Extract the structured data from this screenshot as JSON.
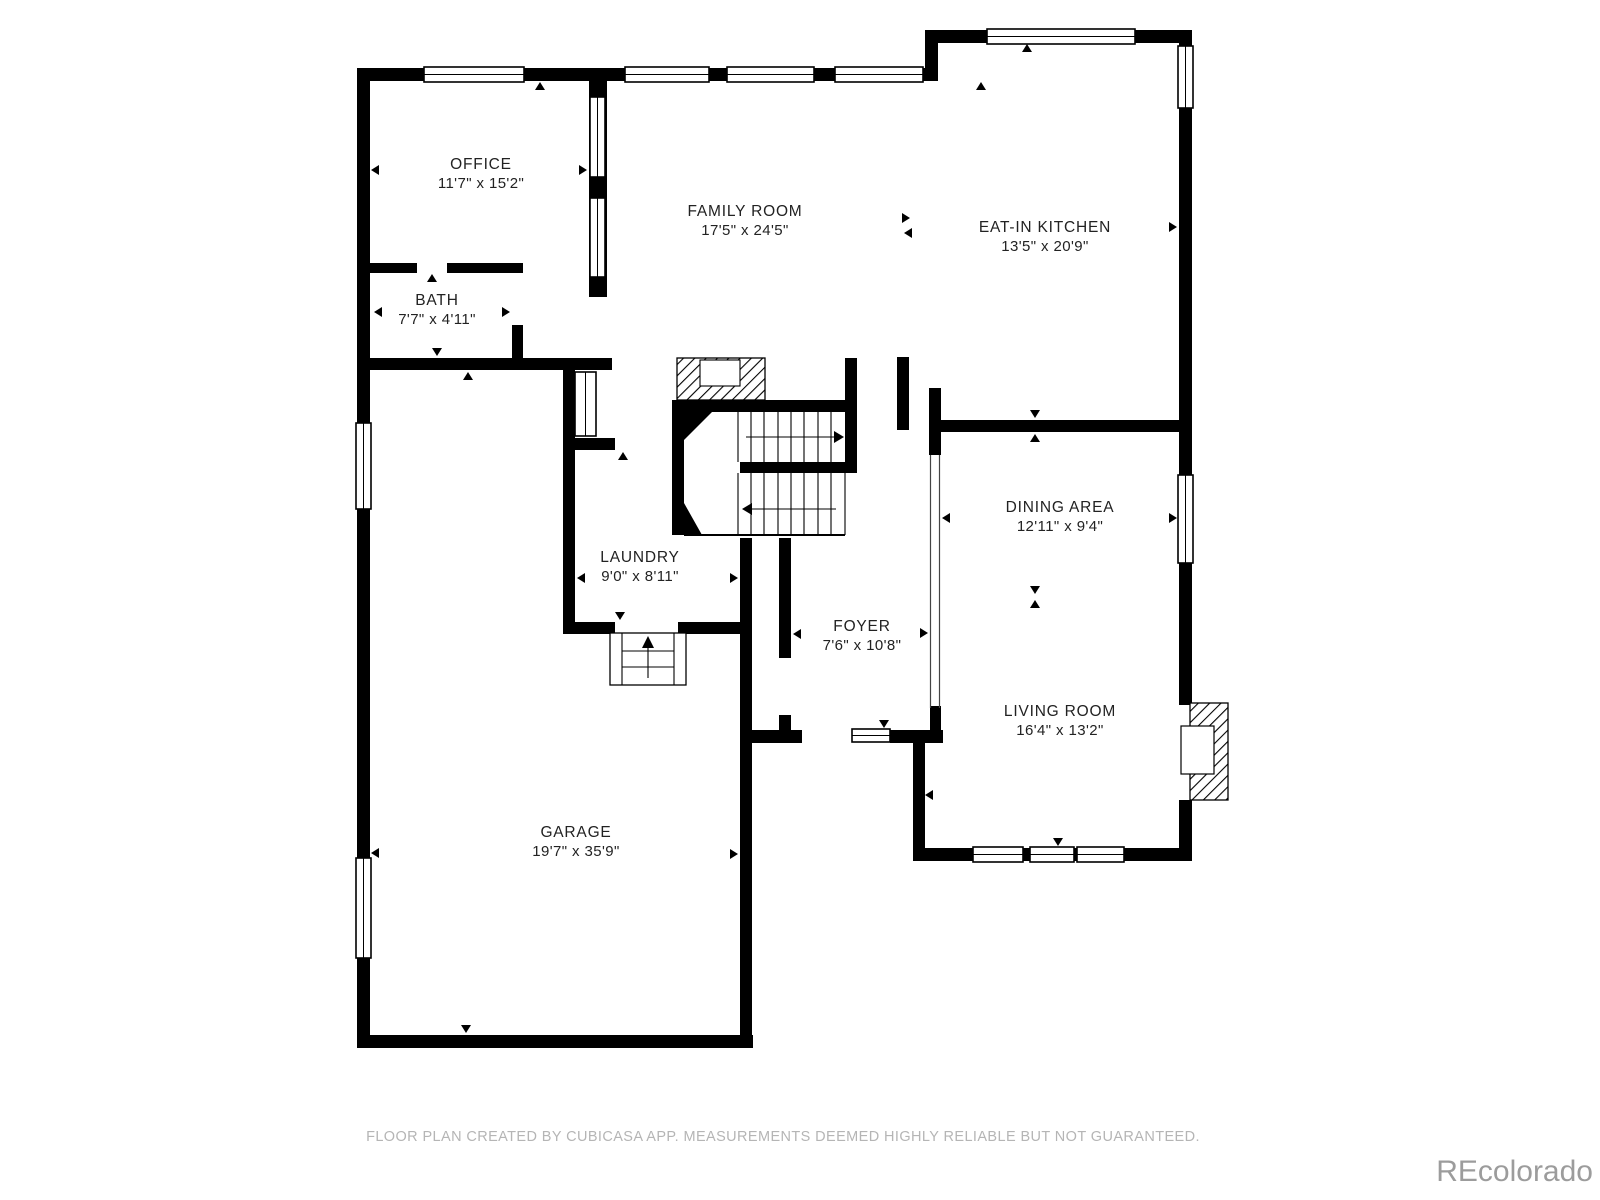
{
  "plan": {
    "creator_line": "FLOOR PLAN CREATED BY CUBICASA APP. MEASUREMENTS DEEMED HIGHLY RELIABLE BUT NOT GUARANTEED.",
    "watermark": "REcolorado"
  },
  "rooms": [
    {
      "id": "office",
      "name": "OFFICE",
      "dims": "11'7\" x 15'2\""
    },
    {
      "id": "family",
      "name": "FAMILY ROOM",
      "dims": "17'5\" x 24'5\""
    },
    {
      "id": "kitchen",
      "name": "EAT-IN KITCHEN",
      "dims": "13'5\" x 20'9\""
    },
    {
      "id": "bath",
      "name": "BATH",
      "dims": "7'7\" x 4'11\""
    },
    {
      "id": "laundry",
      "name": "LAUNDRY",
      "dims": "9'0\" x 8'11\""
    },
    {
      "id": "dining",
      "name": "DINING AREA",
      "dims": "12'11\" x 9'4\""
    },
    {
      "id": "foyer",
      "name": "FOYER",
      "dims": "7'6\" x 10'8\""
    },
    {
      "id": "living",
      "name": "LIVING ROOM",
      "dims": "16'4\" x 13'2\""
    },
    {
      "id": "garage",
      "name": "GARAGE",
      "dims": "19'7\" x 35'9\""
    }
  ],
  "colors": {
    "wall": "#000000",
    "background": "#ffffff",
    "label_text": "#222222",
    "footer_text": "#b5b5b5",
    "watermark_text": "#9c9c9c"
  }
}
